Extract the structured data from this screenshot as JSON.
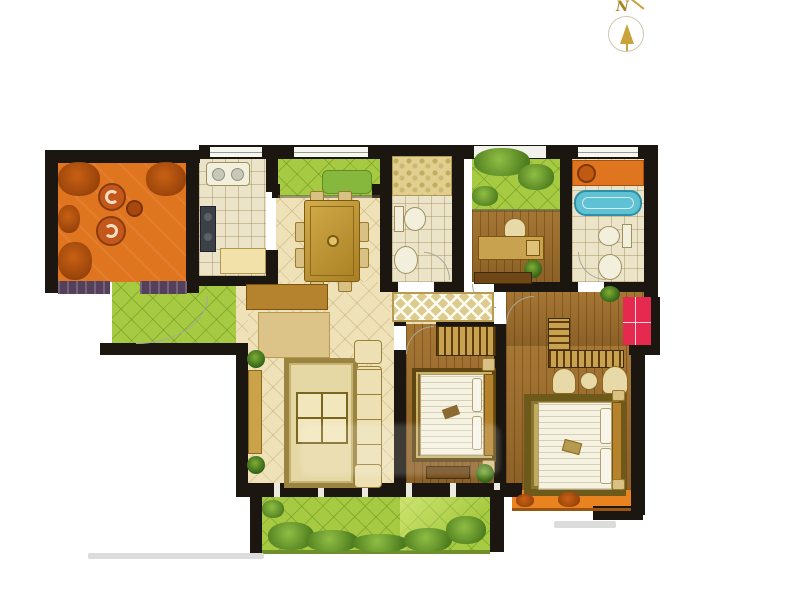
{
  "compass": {
    "label": "N"
  },
  "palette": {
    "wall": "#1b1610",
    "terrace_orange": "#e0751f",
    "balcony_green": "#a6ca41",
    "cream_floor": "#efe2b8",
    "kitchen_tile": "#ece4c8",
    "wood_floor": "#9c6c2b",
    "bathtub_blue": "#5ec1d4",
    "closet_red": "#e6294e",
    "cabinet_tan": "#d9c083",
    "sill_purple": "#54405a",
    "foliage_green": "#4e7d1f",
    "foliage_orange": "#8f3d08"
  },
  "regions": [
    {
      "id": "terrace",
      "kind": "open-balcony"
    },
    {
      "id": "kitchen",
      "kind": "room"
    },
    {
      "id": "north-garden-balcony",
      "kind": "open-balcony"
    },
    {
      "id": "dining-area",
      "kind": "room"
    },
    {
      "id": "bathroom-1",
      "kind": "room"
    },
    {
      "id": "garden-lightwell",
      "kind": "open-balcony"
    },
    {
      "id": "study",
      "kind": "room"
    },
    {
      "id": "bathroom-2",
      "kind": "room"
    },
    {
      "id": "entry-balcony",
      "kind": "open-balcony"
    },
    {
      "id": "living-room",
      "kind": "room"
    },
    {
      "id": "hallway",
      "kind": "room"
    },
    {
      "id": "bedroom-2",
      "kind": "room"
    },
    {
      "id": "master-bedroom",
      "kind": "room"
    },
    {
      "id": "red-closet",
      "kind": "closet"
    },
    {
      "id": "rear-garden-balcony",
      "kind": "open-balcony"
    },
    {
      "id": "master-balcony",
      "kind": "open-balcony"
    }
  ],
  "furniture": [
    "terrace-chairs",
    "kitchen-sink",
    "kitchen-stove",
    "kitchen-counter",
    "garden-bench",
    "dining-table",
    "dining-chairs",
    "toilet",
    "wash-basin",
    "shower-area",
    "bathtub",
    "washing-machine-cabinet",
    "desk",
    "desk-chair",
    "potted-plant",
    "shoe-cabinet",
    "tv-console",
    "sofa-set",
    "coffee-table",
    "area-rug",
    "wardrobe-hangers",
    "double-bed",
    "nightstand",
    "armchairs",
    "side-table",
    "garden-bushes"
  ]
}
